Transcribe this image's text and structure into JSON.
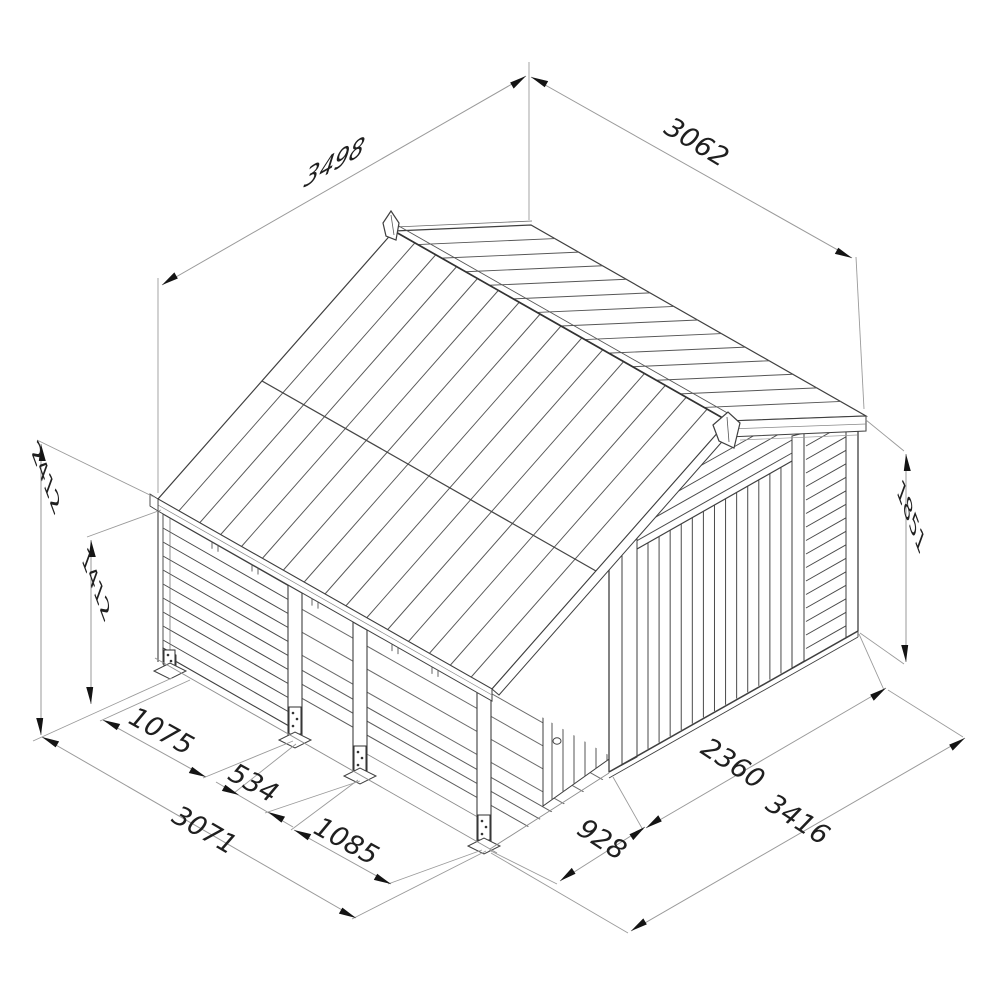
{
  "drawing": {
    "dimensions": {
      "d3498": "3498",
      "d3062": "3062",
      "d2412": "2412",
      "d1412": "1412",
      "d1851": "1851",
      "d1075": "1075",
      "d534": "534",
      "d3071": "3071",
      "d1085": "1085",
      "d928": "928",
      "d2360": "2360",
      "d3416": "3416"
    }
  }
}
